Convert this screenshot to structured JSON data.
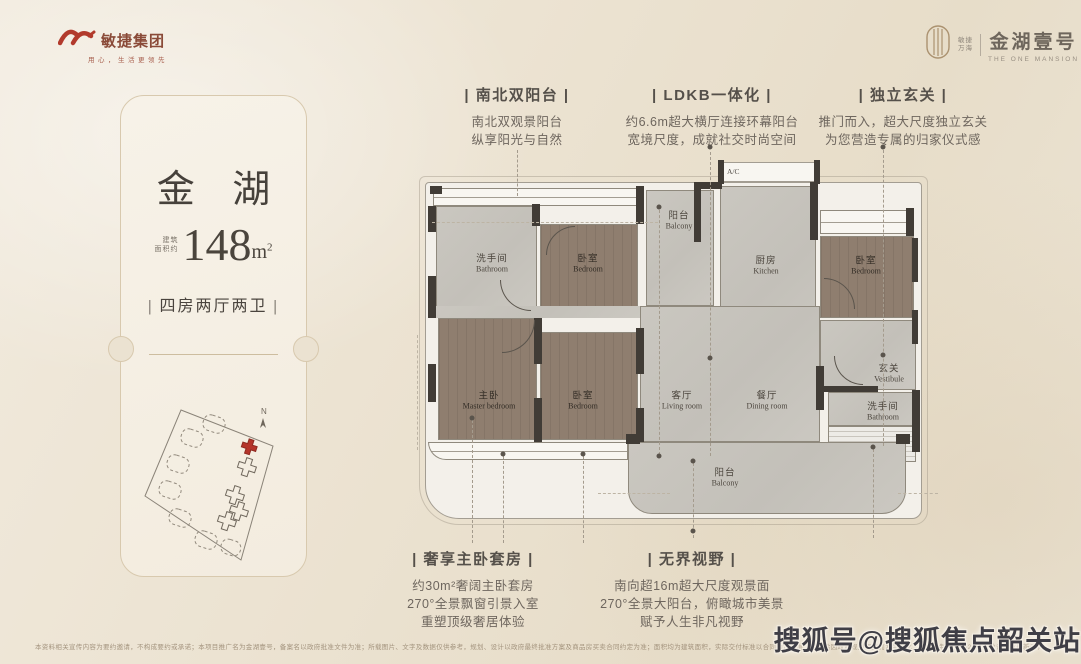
{
  "brand": {
    "group_name": "敏捷集团",
    "group_tagline": "用心，生活更领先",
    "dev_line1": "敏捷",
    "dev_line2": "万海",
    "project_name": "金湖壹号",
    "project_subtitle": "THE ONE MANSION"
  },
  "card": {
    "title": "金 湖",
    "area_label_1": "建筑",
    "area_label_2": "面积约",
    "area_value": "148",
    "area_unit_base": "m",
    "area_unit_sup": "2",
    "layout": "| 四房两厅两卫 |",
    "compass": "N"
  },
  "annotations_top": [
    {
      "title": "| 南北双阳台 |",
      "lines": [
        "南北双观景阳台",
        "纵享阳光与自然"
      ]
    },
    {
      "title": "| LDKB一体化 |",
      "lines": [
        "约6.6m超大横厅连接环幕阳台",
        "宽境尺度，成就社交时尚空间"
      ]
    },
    {
      "title": "| 独立玄关 |",
      "lines": [
        "推门而入，超大尺度独立玄关",
        "为您营造专属的归家仪式感"
      ]
    }
  ],
  "annotations_bottom": [
    {
      "title": "| 奢享主卧套房 |",
      "lines": [
        "约30m²奢阔主卧套房",
        "270°全景飘窗引景入室",
        "重塑顶级奢居体验"
      ]
    },
    {
      "title": "| 无界视野 |",
      "lines": [
        "南向超16m超大尺度观景面",
        "270°全景大阳台，俯瞰城市美景",
        "赋予人生非凡视野"
      ]
    }
  ],
  "floorplan": {
    "ac": "A/C",
    "rooms": [
      {
        "cn": "洗手间",
        "en": "Bathroom"
      },
      {
        "cn": "卧室",
        "en": "Bedroom"
      },
      {
        "cn": "阳台",
        "en": "Balcony"
      },
      {
        "cn": "厨房",
        "en": "Kitchen"
      },
      {
        "cn": "卧室",
        "en": "Bedroom"
      },
      {
        "cn": "主卧",
        "en": "Master bedroom"
      },
      {
        "cn": "卧室",
        "en": "Bedroom"
      },
      {
        "cn": "客厅",
        "en": "Living room"
      },
      {
        "cn": "餐厅",
        "en": "Dining room"
      },
      {
        "cn": "玄关",
        "en": "Vestibule"
      },
      {
        "cn": "洗手间",
        "en": "Bathroom"
      },
      {
        "cn": "阳台",
        "en": "Balcony"
      }
    ]
  },
  "footer": {
    "disclaimer": "本资料相关宣传内容为要约邀请，不构成要约或承诺；本项目推广名为金湖壹号，备案名以政府批准文件为准；所载图片、文字及数据仅供参考，规划、设计以政府最终批准方案及商品房买卖合同约定为准；面积均为建筑面积，实际交付标准以合同约定为准；不排除因政府规划调整而发生变化，本资料制作于2023年，敬请留意最新资料。交通分布、门距信息仅供参考。",
    "watermark": "搜狐号@搜狐焦点韶关站"
  },
  "colors": {
    "accent_red": "#b23a2c",
    "bronze": "#ab9270",
    "wall": "#413c36",
    "wood_floor": "#8f7e6f",
    "gray_floor": "#c7c4bd",
    "page_bg": "#ece3d2"
  }
}
